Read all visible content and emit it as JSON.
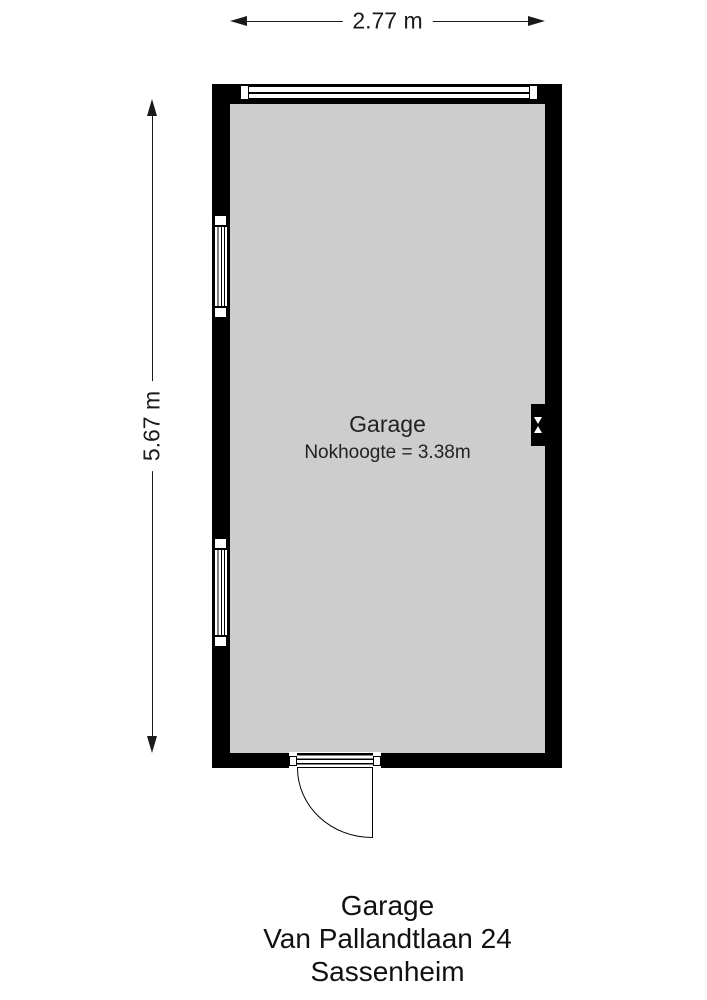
{
  "dimensions": {
    "width_label": "2.77 m",
    "height_label": "5.67 m"
  },
  "room": {
    "name": "Garage",
    "ridge_height_note": "Nokhoogte = 3.38m"
  },
  "caption": {
    "title": "Garage",
    "address": "Van Pallandtlaan 24",
    "city": "Sassenheim"
  },
  "icons": {
    "flue": "hourglass-vent",
    "dimension_arrows": "triangle-arrowheads"
  },
  "colors": {
    "wall": "#000000",
    "floor": "#cdcdcd",
    "line": "#1a1a1a",
    "paper": "#ffffff"
  }
}
